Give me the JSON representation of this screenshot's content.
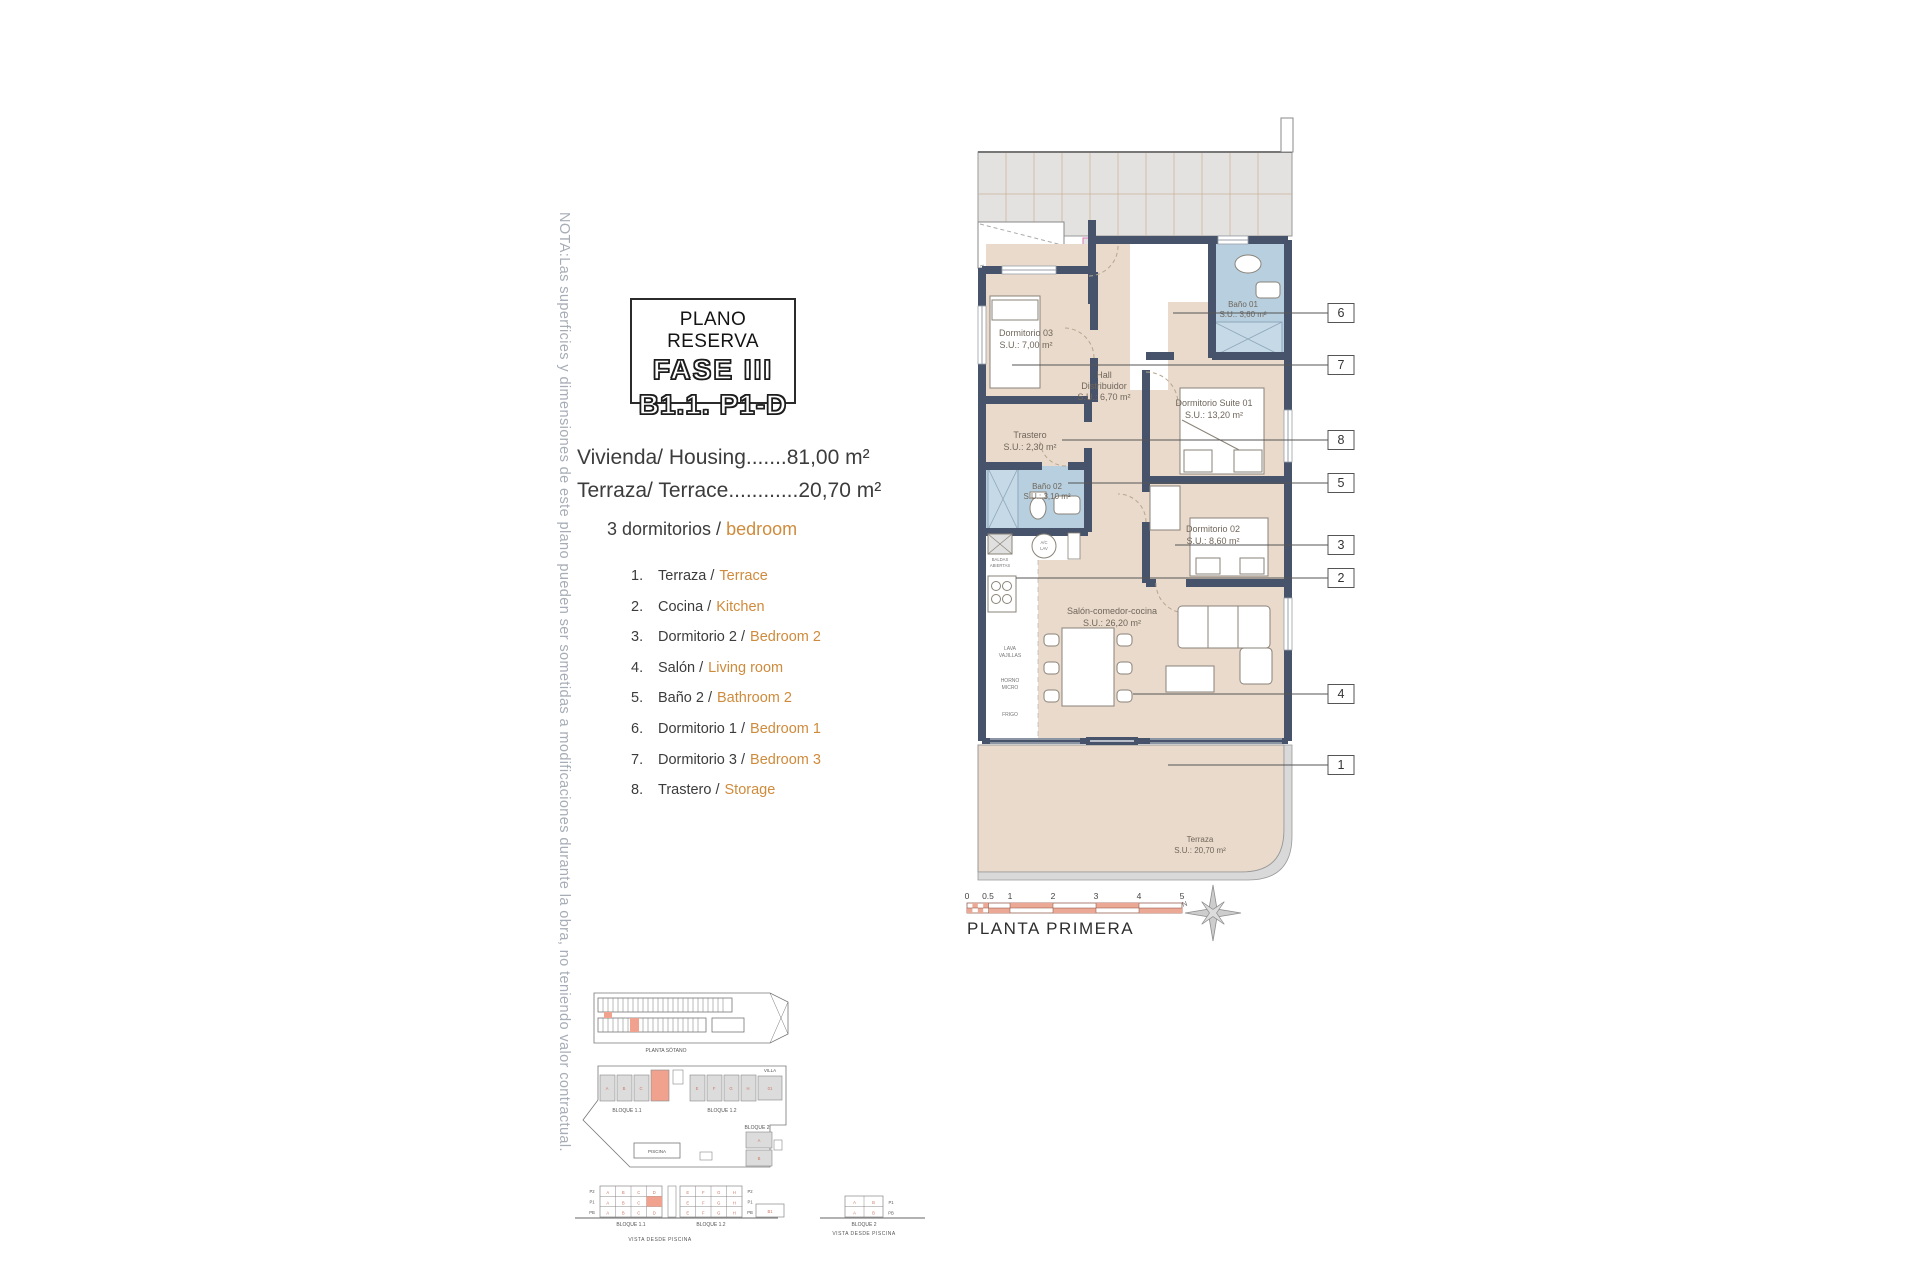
{
  "colors": {
    "room_beige": "#e9dacc",
    "bath_blue": "#b7cfdf",
    "wall_dark": "#46536b",
    "corridor_gray": "#e3e2e0",
    "accent_orange": "#cf8b3c",
    "note_gray": "#a7adb6",
    "highlight_salmon": "#f0a28e",
    "unit_tag_pink": "#d977b8",
    "scale_red": "#eba995"
  },
  "note": "NOTA:Las superficies y dimensiones de este plano pueden ser sometidas a modificaciones durante la obra, no teniendo valor contractual.",
  "title_block": {
    "subtitle": "PLANO RESERVA",
    "phase": "FASE III",
    "unit": "B1.1. P1-D"
  },
  "areas": {
    "housing": "Vivienda/ Housing.......81,00 m²",
    "terrace": "Terraza/ Terrace............20,70 m²"
  },
  "bedrooms_heading": {
    "es": "3 dormitorios /",
    "en": "bedroom"
  },
  "legend": [
    {
      "num": "1.",
      "es": "Terraza /",
      "en": "Terrace"
    },
    {
      "num": "2.",
      "es": "Cocina /",
      "en": "Kitchen"
    },
    {
      "num": "3.",
      "es": "Dormitorio 2 /",
      "en": "Bedroom 2"
    },
    {
      "num": "4.",
      "es": "Salón /",
      "en": "Living room"
    },
    {
      "num": "5.",
      "es": "Baño 2 /",
      "en": "Bathroom 2"
    },
    {
      "num": "6.",
      "es": "Dormitorio 1 /",
      "en": "Bedroom 1"
    },
    {
      "num": "7.",
      "es": "Dormitorio 3 /",
      "en": "Bedroom 3"
    },
    {
      "num": "8.",
      "es": "Trastero /",
      "en": "Storage"
    }
  ],
  "plan": {
    "unit_tag": "1-D",
    "rooms": {
      "dorm03": {
        "name": "Dormitorio 03",
        "area": "S.U.: 7,00 m²"
      },
      "hall": {
        "name1": "Hall",
        "name2": "Distribuidor",
        "area": "S.U.: 6,70 m²"
      },
      "bano01": {
        "name": "Baño 01",
        "area": "S.U.: 3,60 m²"
      },
      "suite01": {
        "name": "Dormitorio Suite 01",
        "area": "S.U.: 13,20 m²"
      },
      "trastero": {
        "name": "Trastero",
        "area": "S.U.: 2,30 m²"
      },
      "bano02": {
        "name": "Baño 02",
        "area": "S.U.: 3,10 m²"
      },
      "dorm02": {
        "name": "Dormitorio 02",
        "area": "S.U.: 8,60 m²"
      },
      "salon": {
        "name": "Salón-comedor-cocina",
        "area": "S.U.: 26,20 m²"
      },
      "terraza": {
        "name": "Terraza",
        "area": "S.U.: 20,70 m²"
      }
    },
    "kitchen": {
      "shelf1": "BALDAS",
      "shelf2": "ABIERTAS",
      "ac1": "A/C",
      "ac2": "LAV",
      "dw1": "LAVA",
      "dw2": "VAJILLAS",
      "oven1": "HORNO",
      "oven2": "MICRO",
      "fridge": "FRIGO"
    },
    "callouts": [
      "6",
      "7",
      "8",
      "5",
      "3",
      "2",
      "4",
      "1"
    ],
    "scale_ticks": [
      "0",
      "0.5",
      "1",
      "2",
      "3",
      "4",
      "5"
    ],
    "floor_label": "PLANTA PRIMERA",
    "compass_n": "N"
  },
  "site": {
    "basement_label": "PLANTA SÓTANO",
    "block11": "BLOQUE 1.1",
    "block12": "BLOQUE 1.2",
    "block2": "BLOQUE 2",
    "villa": "VILLA",
    "villa_unit": "01",
    "pool": "PISCINA",
    "elev": {
      "b11": "BLOQUE 1.1",
      "b12": "BLOQUE 1.2",
      "b2": "BLOQUE 2",
      "view": "VISTA DESDE PISCINA",
      "view2": "VISTA DESDE PISCINA",
      "rows": [
        "P2",
        "P1",
        "PB"
      ],
      "rows_b2": [
        "P1",
        "PB"
      ],
      "units11": [
        "A",
        "B",
        "C",
        "D"
      ],
      "units12": [
        "E",
        "F",
        "G",
        "H"
      ],
      "units2": [
        "A",
        "B"
      ],
      "annex": "B1"
    }
  }
}
